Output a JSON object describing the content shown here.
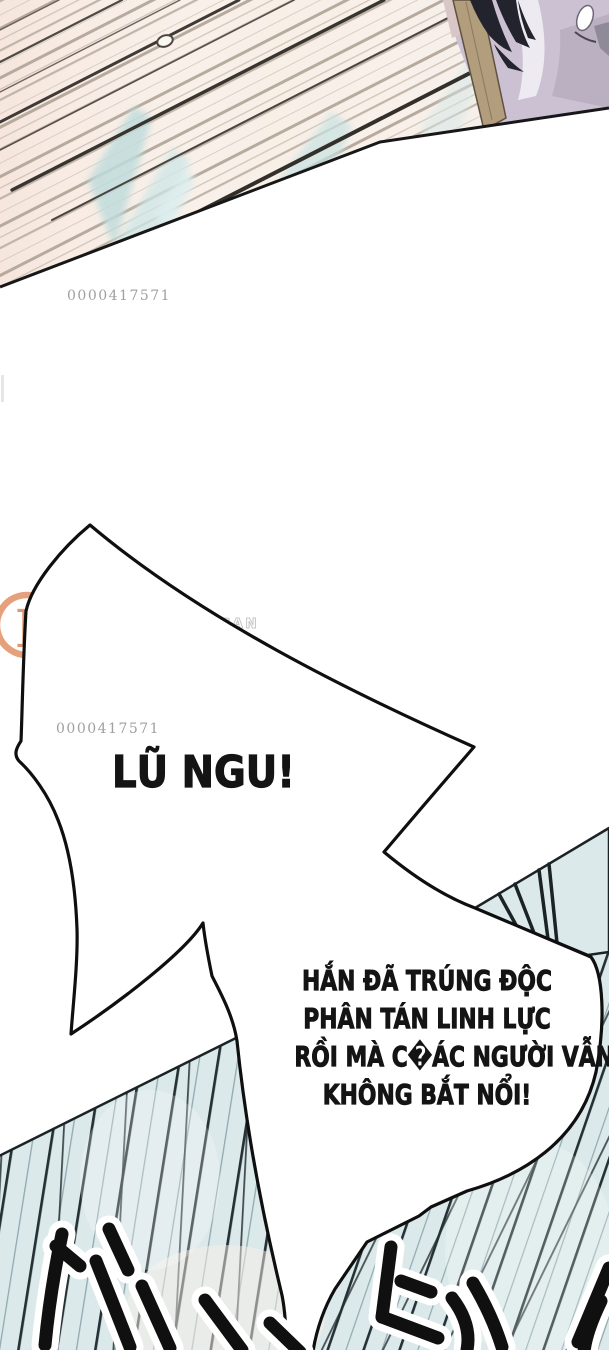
{
  "page": {
    "watermark_id": "0000417571",
    "scan_group": {
      "logo_letter": "R",
      "scan_label": "T'S SCAN"
    }
  },
  "speech": {
    "shout": "LŨ NGU!",
    "dialogue": {
      "lines": [
        "HẮN ĐÃ TRÚNG ĐỘC",
        "PHÂN TÁN LINH LỰC",
        "RỒI MÀ C�ÁC NGƯỜI VẪN",
        "KHÔNG BẮT NỔI!"
      ]
    }
  },
  "icons": {
    "speed_lines": "diagonal-stripe-pattern",
    "speech_bubble": "spiky-burst-bubble",
    "sfx_strokes": "brush-stroke-marks"
  },
  "colors": {
    "top_panel_bg": "#f8efe7",
    "top_panel_line": "#b3a79a",
    "teal_glow": "#c8e2e2",
    "character_coat": "#ccc1d2",
    "strap_tan": "#b29d7c",
    "bottom_panel_bg": "#dbe9eb",
    "speed_line_dark": "#263135",
    "ink": "#141414",
    "watermark_gray": "#a0a0a0",
    "logo_orange": "#e0885a"
  }
}
